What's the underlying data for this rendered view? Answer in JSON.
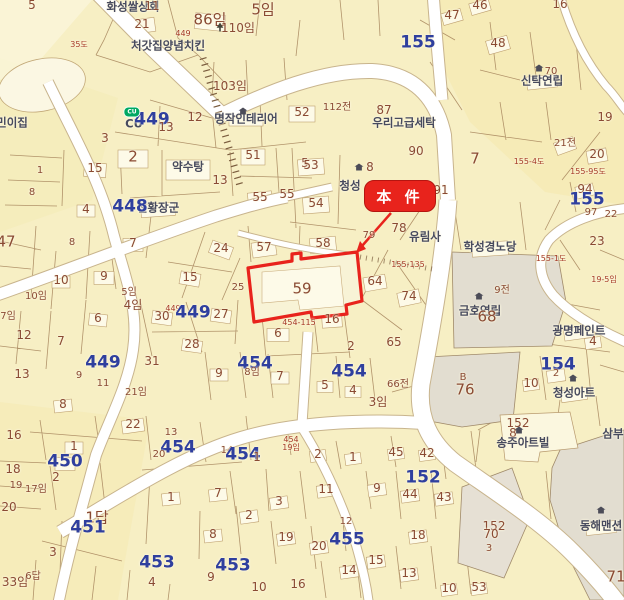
{
  "map": {
    "callout": {
      "label": "本 件"
    },
    "colors": {
      "parcel": "#f7efc4",
      "building": "#fdfae8",
      "boundary": "#a5825a",
      "road": "#ffffff",
      "block_number": "#2f3f9e",
      "lot_number": "#8a4a33",
      "place_name": "#474a5e",
      "road_number": "#a63b28",
      "highlight": "#e8231c",
      "estate": "#e2ddd0",
      "highlight_parcel": "59"
    },
    "labels": [
      {
        "t": "화성쌀상회",
        "x": 133,
        "y": 7,
        "k": "place"
      },
      {
        "t": "11",
        "x": 152,
        "y": 6,
        "k": "lot"
      },
      {
        "t": "5",
        "x": 32,
        "y": 5,
        "k": "lot"
      },
      {
        "t": "21",
        "x": 142,
        "y": 24,
        "k": "lot"
      },
      {
        "t": "86임",
        "x": 210,
        "y": 20,
        "k": "lotlg"
      },
      {
        "t": "5임",
        "x": 263,
        "y": 10,
        "k": "lotlg"
      },
      {
        "t": "110임",
        "x": 238,
        "y": 28,
        "k": "lot"
      },
      {
        "t": "449",
        "x": 183,
        "y": 34,
        "k": "road"
      },
      {
        "t": "35도",
        "x": 79,
        "y": 45,
        "k": "road"
      },
      {
        "t": "처갓집양념치킨",
        "x": 168,
        "y": 46,
        "k": "place"
      },
      {
        "t": "103임",
        "x": 230,
        "y": 86,
        "k": "lot"
      },
      {
        "t": "민이집",
        "x": 12,
        "y": 123,
        "k": "place"
      },
      {
        "t": "CU",
        "x": 134,
        "y": 124,
        "k": "place"
      },
      {
        "t": "449",
        "x": 152,
        "y": 120,
        "k": "block"
      },
      {
        "t": "13",
        "x": 166,
        "y": 127,
        "k": "lot"
      },
      {
        "t": "12",
        "x": 195,
        "y": 117,
        "k": "lot"
      },
      {
        "t": "명작인테리어",
        "x": 246,
        "y": 119,
        "k": "place"
      },
      {
        "t": "52",
        "x": 302,
        "y": 112,
        "k": "lot"
      },
      {
        "t": "3",
        "x": 105,
        "y": 138,
        "k": "lot"
      },
      {
        "t": "2",
        "x": 133,
        "y": 157,
        "k": "lotlg"
      },
      {
        "t": "15",
        "x": 95,
        "y": 168,
        "k": "lot"
      },
      {
        "t": "약수탕",
        "x": 188,
        "y": 167,
        "k": "place"
      },
      {
        "t": "51",
        "x": 253,
        "y": 155,
        "k": "lot"
      },
      {
        "t": "1",
        "x": 40,
        "y": 171,
        "k": "lotsm"
      },
      {
        "t": "8",
        "x": 32,
        "y": 193,
        "k": "lotsm"
      },
      {
        "t": "13",
        "x": 220,
        "y": 180,
        "k": "lot"
      },
      {
        "t": "55",
        "x": 287,
        "y": 194,
        "k": "lot"
      },
      {
        "t": "5",
        "x": 305,
        "y": 163,
        "k": "lot"
      },
      {
        "t": "46",
        "x": 480,
        "y": 5,
        "k": "lot"
      },
      {
        "t": "47",
        "x": 452,
        "y": 15,
        "k": "lot"
      },
      {
        "t": "16",
        "x": 560,
        "y": 4,
        "k": "lot"
      },
      {
        "t": "155",
        "x": 418,
        "y": 43,
        "k": "block"
      },
      {
        "t": "48",
        "x": 498,
        "y": 43,
        "k": "lot"
      },
      {
        "t": "신탁연립",
        "x": 542,
        "y": 81,
        "k": "place"
      },
      {
        "t": "70",
        "x": 551,
        "y": 72,
        "k": "lotsm"
      },
      {
        "t": "19",
        "x": 605,
        "y": 117,
        "k": "lot"
      },
      {
        "t": "112전",
        "x": 337,
        "y": 108,
        "k": "lotsm"
      },
      {
        "t": "87",
        "x": 384,
        "y": 110,
        "k": "lot"
      },
      {
        "t": "우리고급세탁",
        "x": 404,
        "y": 123,
        "k": "place"
      },
      {
        "t": "90",
        "x": 416,
        "y": 151,
        "k": "lot"
      },
      {
        "t": "21전",
        "x": 565,
        "y": 144,
        "k": "lotsm"
      },
      {
        "t": "20",
        "x": 597,
        "y": 154,
        "k": "lot"
      },
      {
        "t": "7",
        "x": 475,
        "y": 159,
        "k": "lotlg"
      },
      {
        "t": "155-4도",
        "x": 529,
        "y": 162,
        "k": "road"
      },
      {
        "t": "155-95도",
        "x": 588,
        "y": 172,
        "k": "road"
      },
      {
        "t": "94",
        "x": 585,
        "y": 189,
        "k": "lot"
      },
      {
        "t": "155",
        "x": 587,
        "y": 200,
        "k": "block"
      },
      {
        "t": "97",
        "x": 591,
        "y": 213,
        "k": "lotsm"
      },
      {
        "t": "22",
        "x": 611,
        "y": 215,
        "k": "lotsm"
      },
      {
        "t": "23",
        "x": 597,
        "y": 241,
        "k": "lot"
      },
      {
        "t": "8",
        "x": 370,
        "y": 167,
        "k": "lot"
      },
      {
        "t": "청성",
        "x": 350,
        "y": 186,
        "k": "place"
      },
      {
        "t": "91",
        "x": 441,
        "y": 190,
        "k": "lot"
      },
      {
        "t": "53",
        "x": 311,
        "y": 165,
        "k": "lot"
      },
      {
        "t": "54",
        "x": 316,
        "y": 203,
        "k": "lot"
      },
      {
        "t": "55",
        "x": 260,
        "y": 197,
        "k": "lot"
      },
      {
        "t": "천황장군",
        "x": 158,
        "y": 208,
        "k": "place"
      },
      {
        "t": "57",
        "x": 264,
        "y": 247,
        "k": "lot"
      },
      {
        "t": "58",
        "x": 323,
        "y": 243,
        "k": "lot"
      },
      {
        "t": "79",
        "x": 369,
        "y": 236,
        "k": "lotsm"
      },
      {
        "t": "78",
        "x": 399,
        "y": 228,
        "k": "lot"
      },
      {
        "t": "유림사",
        "x": 425,
        "y": 237,
        "k": "place"
      },
      {
        "t": "학성경노당",
        "x": 490,
        "y": 247,
        "k": "place"
      },
      {
        "t": "24",
        "x": 221,
        "y": 248,
        "k": "lot"
      },
      {
        "t": "15",
        "x": 190,
        "y": 277,
        "k": "lot"
      },
      {
        "t": "25",
        "x": 238,
        "y": 288,
        "k": "lotsm"
      },
      {
        "t": "59",
        "x": 302,
        "y": 289,
        "k": "lotlg"
      },
      {
        "t": "64",
        "x": 375,
        "y": 281,
        "k": "lot"
      },
      {
        "t": "74",
        "x": 409,
        "y": 296,
        "k": "lot"
      },
      {
        "t": "155-135",
        "x": 408,
        "y": 265,
        "k": "road"
      },
      {
        "t": "금호연립",
        "x": 480,
        "y": 311,
        "k": "place"
      },
      {
        "t": "68",
        "x": 487,
        "y": 317,
        "k": "lotlg"
      },
      {
        "t": "9전",
        "x": 502,
        "y": 291,
        "k": "lotsm"
      },
      {
        "t": "449",
        "x": 173,
        "y": 309,
        "k": "road"
      },
      {
        "t": "449",
        "x": 193,
        "y": 313,
        "k": "block"
      },
      {
        "t": "30",
        "x": 162,
        "y": 316,
        "k": "lot"
      },
      {
        "t": "27",
        "x": 221,
        "y": 314,
        "k": "lot"
      },
      {
        "t": "16",
        "x": 332,
        "y": 319,
        "k": "lot"
      },
      {
        "t": "6",
        "x": 278,
        "y": 333,
        "k": "lot"
      },
      {
        "t": "28",
        "x": 192,
        "y": 344,
        "k": "lot"
      },
      {
        "t": "65",
        "x": 394,
        "y": 342,
        "k": "lot"
      },
      {
        "t": "2",
        "x": 351,
        "y": 346,
        "k": "lot"
      },
      {
        "t": "454-115",
        "x": 299,
        "y": 323,
        "k": "road"
      },
      {
        "t": "광명페인트",
        "x": 579,
        "y": 331,
        "k": "place"
      },
      {
        "t": "4",
        "x": 593,
        "y": 341,
        "k": "lot"
      },
      {
        "t": "154",
        "x": 558,
        "y": 365,
        "k": "block"
      },
      {
        "t": "2",
        "x": 556,
        "y": 374,
        "k": "lotsm"
      },
      {
        "t": "10",
        "x": 531,
        "y": 383,
        "k": "lot"
      },
      {
        "t": "청성아트",
        "x": 574,
        "y": 393,
        "k": "place"
      },
      {
        "t": "B",
        "x": 463,
        "y": 378,
        "k": "lotsm"
      },
      {
        "t": "76",
        "x": 465,
        "y": 390,
        "k": "lotlg"
      },
      {
        "t": "19-5임",
        "x": 604,
        "y": 280,
        "k": "road"
      },
      {
        "t": "155-1도",
        "x": 551,
        "y": 259,
        "k": "road"
      },
      {
        "t": "47",
        "x": 6,
        "y": 242,
        "k": "lotlg"
      },
      {
        "t": "4",
        "x": 86,
        "y": 209,
        "k": "lot"
      },
      {
        "t": "448",
        "x": 130,
        "y": 207,
        "k": "block"
      },
      {
        "t": "8",
        "x": 72,
        "y": 243,
        "k": "lotsm"
      },
      {
        "t": "7",
        "x": 133,
        "y": 243,
        "k": "lot"
      },
      {
        "t": "10",
        "x": 61,
        "y": 280,
        "k": "lot"
      },
      {
        "t": "9",
        "x": 104,
        "y": 276,
        "k": "lot"
      },
      {
        "t": "10임",
        "x": 36,
        "y": 297,
        "k": "lotsm"
      },
      {
        "t": "5임",
        "x": 129,
        "y": 293,
        "k": "lotsm"
      },
      {
        "t": "4임",
        "x": 133,
        "y": 305,
        "k": "lot"
      },
      {
        "t": "6",
        "x": 98,
        "y": 318,
        "k": "lot"
      },
      {
        "t": "7임",
        "x": 8,
        "y": 317,
        "k": "lotsm"
      },
      {
        "t": "12",
        "x": 24,
        "y": 335,
        "k": "lot"
      },
      {
        "t": "7",
        "x": 61,
        "y": 341,
        "k": "lot"
      },
      {
        "t": "13",
        "x": 22,
        "y": 374,
        "k": "lot"
      },
      {
        "t": "449",
        "x": 103,
        "y": 363,
        "k": "block"
      },
      {
        "t": "9",
        "x": 79,
        "y": 376,
        "k": "lotsm"
      },
      {
        "t": "11",
        "x": 103,
        "y": 384,
        "k": "lotsm"
      },
      {
        "t": "31",
        "x": 152,
        "y": 361,
        "k": "lot"
      },
      {
        "t": "21임",
        "x": 136,
        "y": 393,
        "k": "lotsm"
      },
      {
        "t": "454",
        "x": 255,
        "y": 364,
        "k": "block"
      },
      {
        "t": "8임",
        "x": 252,
        "y": 373,
        "k": "lotsm"
      },
      {
        "t": "9",
        "x": 219,
        "y": 373,
        "k": "lot"
      },
      {
        "t": "7",
        "x": 280,
        "y": 376,
        "k": "lot"
      },
      {
        "t": "5",
        "x": 325,
        "y": 385,
        "k": "lot"
      },
      {
        "t": "454",
        "x": 349,
        "y": 372,
        "k": "block"
      },
      {
        "t": "4",
        "x": 353,
        "y": 390,
        "k": "lot"
      },
      {
        "t": "66전",
        "x": 398,
        "y": 385,
        "k": "lotsm"
      },
      {
        "t": "3임",
        "x": 378,
        "y": 402,
        "k": "lot"
      },
      {
        "t": "8",
        "x": 63,
        "y": 404,
        "k": "lot"
      },
      {
        "t": "16",
        "x": 14,
        "y": 435,
        "k": "lot"
      },
      {
        "t": "22",
        "x": 133,
        "y": 424,
        "k": "lot"
      },
      {
        "t": "13",
        "x": 171,
        "y": 433,
        "k": "lotsm"
      },
      {
        "t": "1",
        "x": 74,
        "y": 446,
        "k": "lot"
      },
      {
        "t": "450",
        "x": 65,
        "y": 462,
        "k": "block"
      },
      {
        "t": "2",
        "x": 56,
        "y": 477,
        "k": "lot"
      },
      {
        "t": "18",
        "x": 13,
        "y": 469,
        "k": "lot"
      },
      {
        "t": "19",
        "x": 16,
        "y": 486,
        "k": "lotsm"
      },
      {
        "t": "17임",
        "x": 36,
        "y": 490,
        "k": "lotsm"
      },
      {
        "t": "20",
        "x": 9,
        "y": 507,
        "k": "lot"
      },
      {
        "t": "454",
        "x": 178,
        "y": 448,
        "k": "block"
      },
      {
        "t": "20",
        "x": 159,
        "y": 455,
        "k": "lotsm"
      },
      {
        "t": "14",
        "x": 227,
        "y": 451,
        "k": "lotsm"
      },
      {
        "t": "454",
        "x": 243,
        "y": 455,
        "k": "block"
      },
      {
        "t": "1",
        "x": 257,
        "y": 457,
        "k": "lot"
      },
      {
        "t": "454",
        "x": 291,
        "y": 440,
        "k": "road"
      },
      {
        "t": "19임",
        "x": 291,
        "y": 448,
        "k": "road"
      },
      {
        "t": "1답",
        "x": 97,
        "y": 518,
        "k": "lotlg"
      },
      {
        "t": "451",
        "x": 88,
        "y": 528,
        "k": "block"
      },
      {
        "t": "3",
        "x": 53,
        "y": 552,
        "k": "lot"
      },
      {
        "t": "33임",
        "x": 15,
        "y": 582,
        "k": "lot"
      },
      {
        "t": "6답",
        "x": 33,
        "y": 577,
        "k": "lotsm"
      },
      {
        "t": "453",
        "x": 157,
        "y": 563,
        "k": "block"
      },
      {
        "t": "9",
        "x": 211,
        "y": 577,
        "k": "lot"
      },
      {
        "t": "4",
        "x": 152,
        "y": 582,
        "k": "lot"
      },
      {
        "t": "10",
        "x": 259,
        "y": 587,
        "k": "lot"
      },
      {
        "t": "1",
        "x": 171,
        "y": 497,
        "k": "lot"
      },
      {
        "t": "7",
        "x": 218,
        "y": 493,
        "k": "lot"
      },
      {
        "t": "2",
        "x": 249,
        "y": 515,
        "k": "lot"
      },
      {
        "t": "3",
        "x": 279,
        "y": 501,
        "k": "lot"
      },
      {
        "t": "8",
        "x": 213,
        "y": 534,
        "k": "lot"
      },
      {
        "t": "19",
        "x": 286,
        "y": 537,
        "k": "lot"
      },
      {
        "t": "453",
        "x": 233,
        "y": 566,
        "k": "block"
      },
      {
        "t": "16",
        "x": 298,
        "y": 584,
        "k": "lot"
      },
      {
        "t": "2",
        "x": 318,
        "y": 454,
        "k": "lot"
      },
      {
        "t": "1",
        "x": 353,
        "y": 457,
        "k": "lot"
      },
      {
        "t": "45",
        "x": 396,
        "y": 452,
        "k": "lot"
      },
      {
        "t": "42",
        "x": 427,
        "y": 453,
        "k": "lot"
      },
      {
        "t": "11",
        "x": 326,
        "y": 489,
        "k": "lot"
      },
      {
        "t": "9",
        "x": 377,
        "y": 488,
        "k": "lot"
      },
      {
        "t": "152",
        "x": 423,
        "y": 478,
        "k": "block"
      },
      {
        "t": "44",
        "x": 410,
        "y": 494,
        "k": "lot"
      },
      {
        "t": "43",
        "x": 444,
        "y": 497,
        "k": "lot"
      },
      {
        "t": "12",
        "x": 346,
        "y": 522,
        "k": "lotsm"
      },
      {
        "t": "455",
        "x": 347,
        "y": 540,
        "k": "block"
      },
      {
        "t": "20",
        "x": 319,
        "y": 546,
        "k": "lot"
      },
      {
        "t": "18",
        "x": 418,
        "y": 535,
        "k": "lot"
      },
      {
        "t": "15",
        "x": 376,
        "y": 560,
        "k": "lot"
      },
      {
        "t": "14",
        "x": 349,
        "y": 570,
        "k": "lot"
      },
      {
        "t": "13",
        "x": 409,
        "y": 573,
        "k": "lot"
      },
      {
        "t": "10",
        "x": 449,
        "y": 588,
        "k": "lot"
      },
      {
        "t": "53",
        "x": 479,
        "y": 587,
        "k": "lot"
      },
      {
        "t": "152",
        "x": 494,
        "y": 526,
        "k": "lot"
      },
      {
        "t": "70",
        "x": 491,
        "y": 534,
        "k": "lot"
      },
      {
        "t": "3",
        "x": 489,
        "y": 549,
        "k": "lotsm"
      },
      {
        "t": "152",
        "x": 518,
        "y": 423,
        "k": "lot"
      },
      {
        "t": "8",
        "x": 513,
        "y": 433,
        "k": "lot"
      },
      {
        "t": "송주아트빌",
        "x": 523,
        "y": 443,
        "k": "place"
      },
      {
        "t": "삼부",
        "x": 613,
        "y": 434,
        "k": "place"
      },
      {
        "t": "동해맨션",
        "x": 601,
        "y": 526,
        "k": "place"
      },
      {
        "t": "71",
        "x": 616,
        "y": 577,
        "k": "lotlg"
      }
    ],
    "icons": [
      {
        "k": "tree",
        "x": 220,
        "y": 27
      },
      {
        "k": "cu",
        "x": 132,
        "y": 112,
        "t": "CU"
      },
      {
        "k": "house",
        "x": 243,
        "y": 111
      },
      {
        "k": "house",
        "x": 359,
        "y": 167
      },
      {
        "k": "house",
        "x": 539,
        "y": 68
      },
      {
        "k": "house",
        "x": 479,
        "y": 296
      },
      {
        "k": "house",
        "x": 573,
        "y": 378
      },
      {
        "k": "house",
        "x": 519,
        "y": 430
      },
      {
        "k": "house",
        "x": 601,
        "y": 510
      }
    ]
  }
}
